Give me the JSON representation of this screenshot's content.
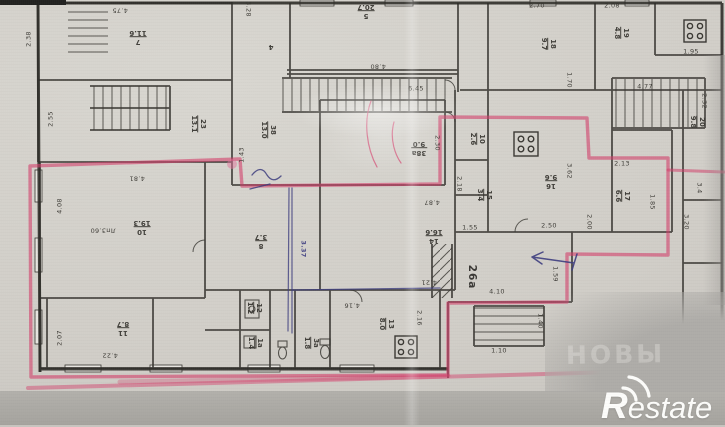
{
  "document_type": "floor-plan-scan",
  "entrance_label": {
    "text": "26а",
    "x": 471,
    "y": 277,
    "rot": 90
  },
  "rooms": [
    {
      "number": "7",
      "area": "11.6",
      "x": 138,
      "y": 37,
      "rot": 180
    },
    {
      "number": "23",
      "area": "13.1",
      "x": 198,
      "y": 124,
      "rot": 90
    },
    {
      "number": "4",
      "area": "",
      "x": 271,
      "y": 46,
      "rot": 180
    },
    {
      "number": "5",
      "area": "20.7",
      "x": 366,
      "y": 11,
      "rot": 180
    },
    {
      "number": "38",
      "area": "13.0",
      "x": 268,
      "y": 130,
      "rot": 90
    },
    {
      "number": "38а",
      "area": "9.0",
      "x": 419,
      "y": 148,
      "rot": 180
    },
    {
      "number": "18",
      "area": "9.7",
      "x": 548,
      "y": 44,
      "rot": 90
    },
    {
      "number": "19",
      "area": "4.8",
      "x": 621,
      "y": 33,
      "rot": 90
    },
    {
      "number": "20",
      "area": "9.8",
      "x": 697,
      "y": 122,
      "rot": 90
    },
    {
      "number": "10",
      "area": "2.6",
      "x": 477,
      "y": 139,
      "rot": 90
    },
    {
      "number": "16",
      "area": "9.6",
      "x": 551,
      "y": 181,
      "rot": 180
    },
    {
      "number": "15",
      "area": "3.4",
      "x": 484,
      "y": 195,
      "rot": 90
    },
    {
      "number": "17",
      "area": "6.6",
      "x": 622,
      "y": 196,
      "rot": 90
    },
    {
      "number": "10",
      "area": "19.3",
      "x": 142,
      "y": 227,
      "rot": 180
    },
    {
      "number": "8",
      "area": "3.7",
      "x": 261,
      "y": 241,
      "rot": 180
    },
    {
      "number": "14",
      "area": "16.6",
      "x": 434,
      "y": 236,
      "rot": 180
    },
    {
      "number": "11",
      "area": "8.7",
      "x": 123,
      "y": 328,
      "rot": 180
    },
    {
      "number": "13",
      "area": "8.0",
      "x": 386,
      "y": 324,
      "rot": 90
    },
    {
      "number": "12",
      "area": "1.2",
      "x": 254,
      "y": 308,
      "rot": 90
    },
    {
      "number": "1а",
      "area": "1.4",
      "x": 255,
      "y": 343,
      "rot": 90
    },
    {
      "number": "3а",
      "area": "1.8",
      "x": 311,
      "y": 343,
      "rot": 90
    }
  ],
  "dimensions": [
    {
      "text": "4.75",
      "x": 120,
      "y": 10,
      "rot": 180
    },
    {
      "text": "2.38",
      "x": 29,
      "y": 39,
      "rot": -90
    },
    {
      "text": "2.55",
      "x": 51,
      "y": 119,
      "rot": -90
    },
    {
      "text": "1.43",
      "x": 242,
      "y": 155,
      "rot": -90
    },
    {
      "text": "3.28",
      "x": 248,
      "y": 9,
      "rot": 90
    },
    {
      "text": "4.80",
      "x": 378,
      "y": 66,
      "rot": 180
    },
    {
      "text": "6.45",
      "x": 416,
      "y": 89,
      "rot": 0
    },
    {
      "text": "2.70",
      "x": 537,
      "y": 6,
      "rot": 0
    },
    {
      "text": "2.08",
      "x": 612,
      "y": 6,
      "rot": 0
    },
    {
      "text": "1.70",
      "x": 569,
      "y": 80,
      "rot": 90
    },
    {
      "text": "1.95",
      "x": 691,
      "y": 52,
      "rot": 0
    },
    {
      "text": "4.77",
      "x": 645,
      "y": 87,
      "rot": 0
    },
    {
      "text": "2.32",
      "x": 704,
      "y": 101,
      "rot": 90
    },
    {
      "text": "2.30",
      "x": 437,
      "y": 143,
      "rot": 90
    },
    {
      "text": "2.13",
      "x": 622,
      "y": 164,
      "rot": 0
    },
    {
      "text": "3.62",
      "x": 569,
      "y": 171,
      "rot": 90
    },
    {
      "text": "2.18",
      "x": 459,
      "y": 184,
      "rot": 90
    },
    {
      "text": "3.4",
      "x": 699,
      "y": 188,
      "rot": 90
    },
    {
      "text": "1.85",
      "x": 652,
      "y": 202,
      "rot": 90
    },
    {
      "text": "3.20",
      "x": 686,
      "y": 222,
      "rot": 90
    },
    {
      "text": "4.81",
      "x": 137,
      "y": 178,
      "rot": 180
    },
    {
      "text": "4.08",
      "x": 60,
      "y": 206,
      "rot": -90
    },
    {
      "text": "Лп3.60",
      "x": 103,
      "y": 230,
      "rot": 180
    },
    {
      "text": "4.87",
      "x": 432,
      "y": 202,
      "rot": 180
    },
    {
      "text": "2.00",
      "x": 589,
      "y": 222,
      "rot": 90
    },
    {
      "text": "2.50",
      "x": 549,
      "y": 226,
      "rot": 0
    },
    {
      "text": "1.55",
      "x": 470,
      "y": 228,
      "rot": 0
    },
    {
      "text": "4.21",
      "x": 429,
      "y": 282,
      "rot": 180
    },
    {
      "text": "3.37",
      "x": 303,
      "y": 249,
      "rot": 90,
      "cls": "blue"
    },
    {
      "text": "1.59",
      "x": 555,
      "y": 274,
      "rot": 90
    },
    {
      "text": "4.10",
      "x": 497,
      "y": 292,
      "rot": 0
    },
    {
      "text": "1.40",
      "x": 540,
      "y": 321,
      "rot": 90
    },
    {
      "text": "1.10",
      "x": 499,
      "y": 351,
      "rot": 0
    },
    {
      "text": "2.07",
      "x": 60,
      "y": 338,
      "rot": -90
    },
    {
      "text": "4.22",
      "x": 110,
      "y": 355,
      "rot": 180
    },
    {
      "text": "4.16",
      "x": 352,
      "y": 305,
      "rot": 180
    },
    {
      "text": "2.16",
      "x": 419,
      "y": 318,
      "rot": 90
    },
    {
      "text": "2.",
      "x": 45,
      "y": 420,
      "rot": -60
    }
  ],
  "colors": {
    "red_marker": "#d23f6b",
    "blue_pen": "#3d3d7e",
    "wall_ink": "#3a3833",
    "paper": "#d4d2cc"
  },
  "brand": {
    "r": "R",
    "rest": "estate",
    "faint_watermark": "НОВЫ"
  }
}
